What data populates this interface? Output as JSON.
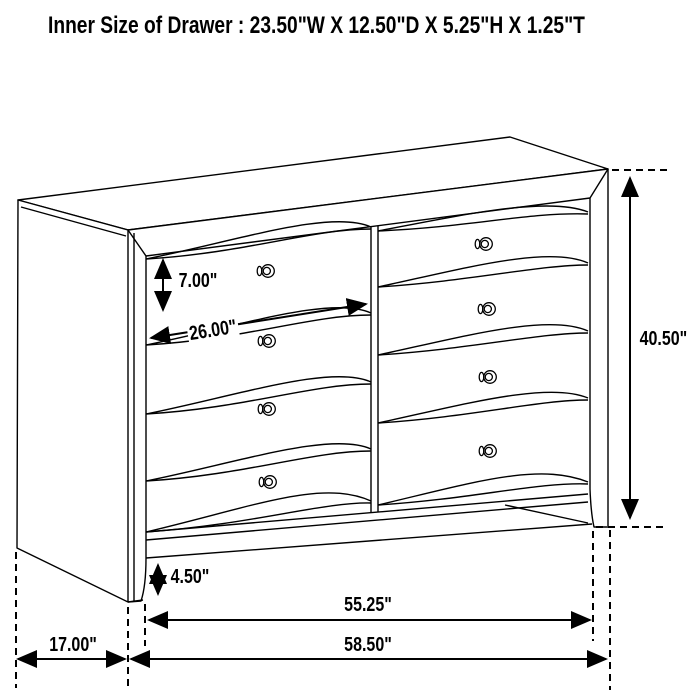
{
  "title": "Inner Size of Drawer : 23.50\"W X 12.50\"D X 5.25\"H X 1.25\"T",
  "figure": {
    "kind": "furniture-dimension-line-drawing",
    "item": "eight-drawer dresser",
    "drawer_columns": 2,
    "drawers_per_column": 4,
    "colors": {
      "line": "#000000",
      "background": "#ffffff"
    }
  },
  "labels": {
    "drawer_height": "7.00\"",
    "drawer_width": "26.00\"",
    "overall_height": "40.50\"",
    "base_height": "4.50\"",
    "inner_width": "55.25\"",
    "overall_width": "58.50\"",
    "depth": "17.00\""
  }
}
